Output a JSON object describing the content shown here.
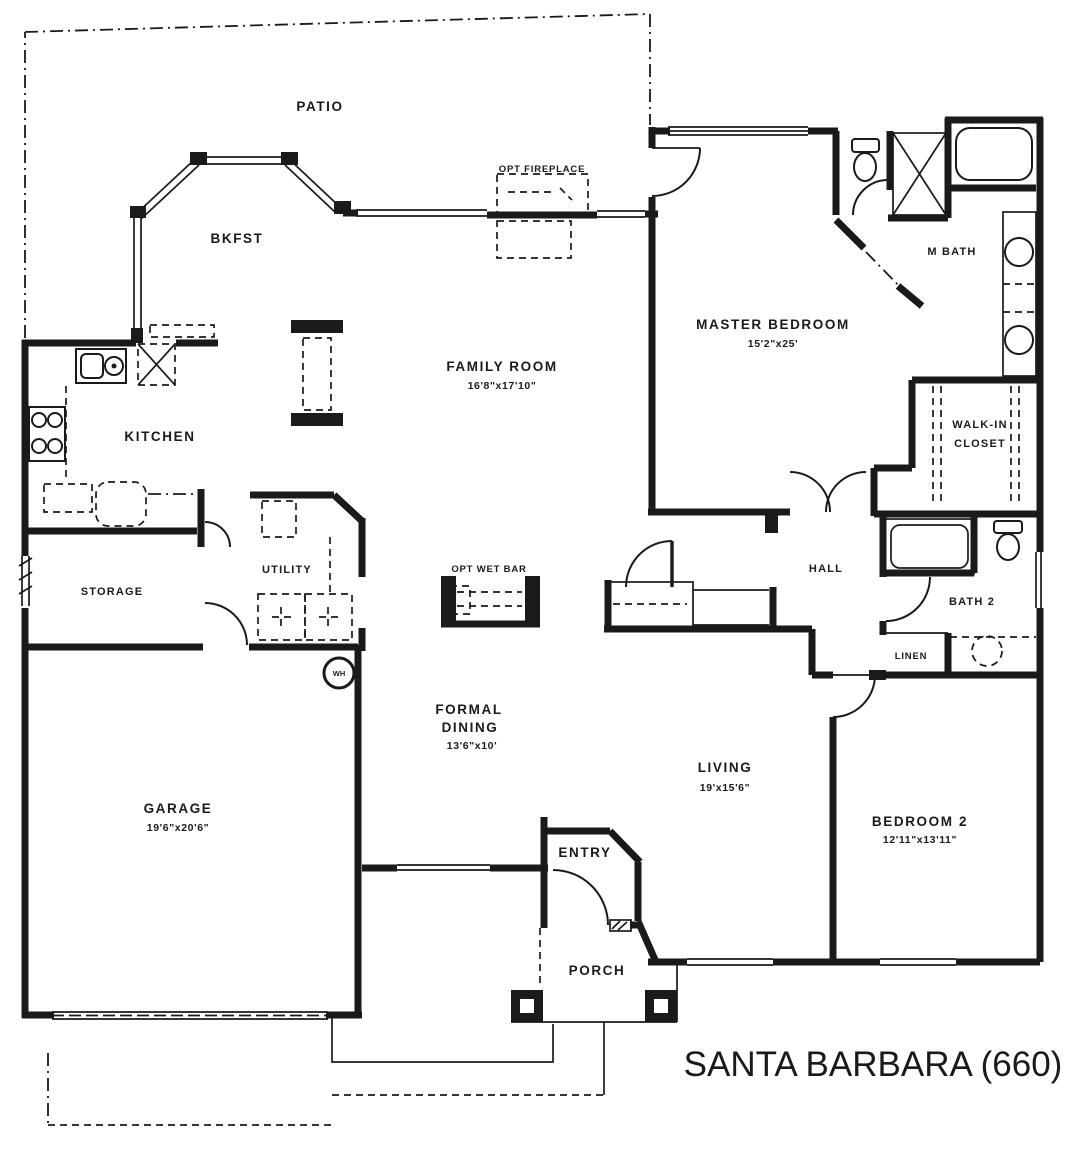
{
  "plan": {
    "title": "SANTA BARBARA (660)"
  },
  "rooms": {
    "patio": {
      "label": "PATIO"
    },
    "bkfst": {
      "label": "BKFST"
    },
    "kitchen": {
      "label": "KITCHEN"
    },
    "storage": {
      "label": "STORAGE"
    },
    "utility": {
      "label": "UTILITY"
    },
    "garage": {
      "label": "GARAGE",
      "dims": "19'6\"x20'6\""
    },
    "family_room": {
      "label": "FAMILY ROOM",
      "dims": "16'8\"x17'10\""
    },
    "master_bedroom": {
      "label": "MASTER BEDROOM",
      "dims": "15'2\"x25'"
    },
    "master_bath": {
      "label": "M BATH"
    },
    "walk_in_closet": {
      "line1": "WALK-IN",
      "line2": "CLOSET"
    },
    "hall": {
      "label": "HALL"
    },
    "bath2": {
      "label": "BATH 2"
    },
    "linen": {
      "label": "LINEN"
    },
    "formal_dining": {
      "line1": "FORMAL",
      "line2": "DINING",
      "dims": "13'6\"x10'"
    },
    "living": {
      "label": "LIVING",
      "dims": "19'x15'6\""
    },
    "bedroom2": {
      "label": "BEDROOM 2",
      "dims": "12'11\"x13'11\""
    },
    "entry": {
      "label": "ENTRY"
    },
    "porch": {
      "label": "PORCH"
    }
  },
  "features": {
    "opt_fireplace": {
      "label": "OPT FIREPLACE"
    },
    "opt_wet_bar": {
      "label": "OPT WET BAR"
    },
    "water_heater": {
      "label": "WH"
    }
  },
  "colors": {
    "ink": "#1a1a1a",
    "paper": "#ffffff"
  }
}
